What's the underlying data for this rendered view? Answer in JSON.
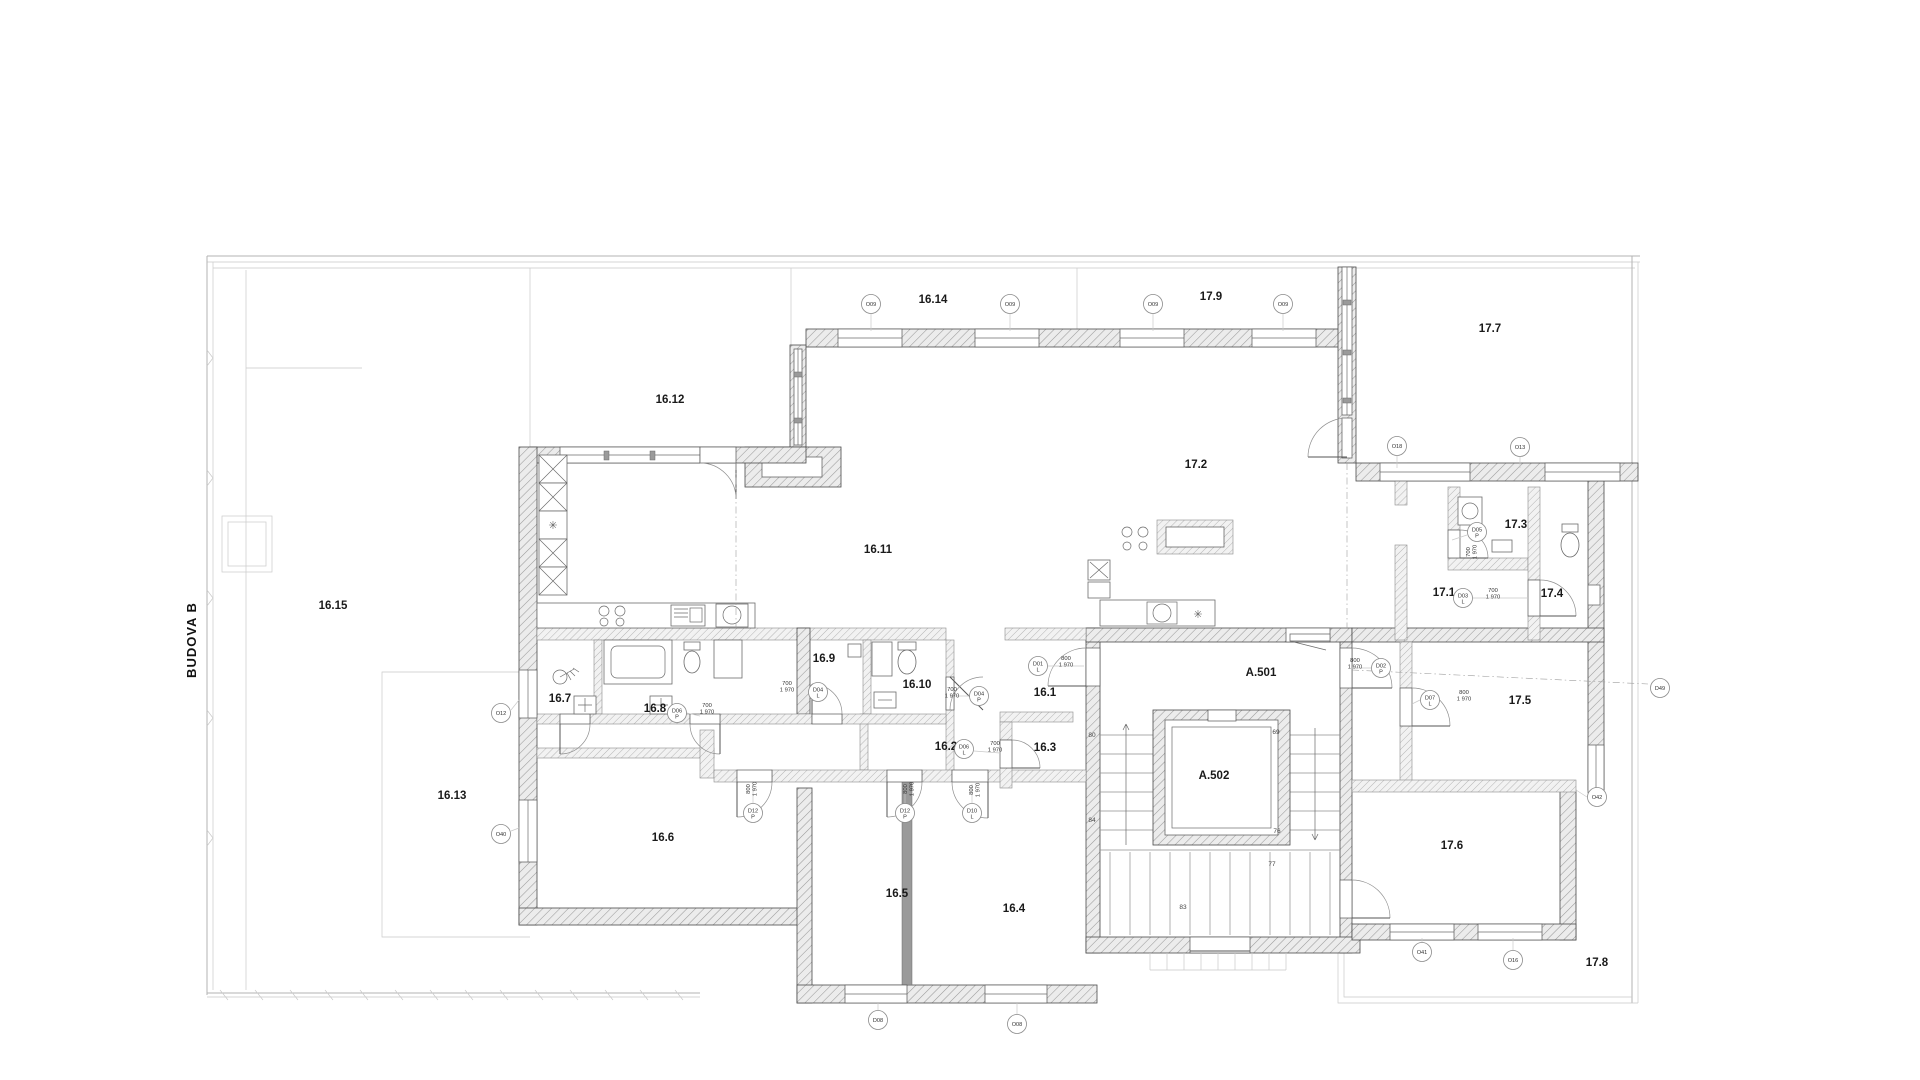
{
  "drawing": {
    "building_label": "BUDOVA B",
    "colors": {
      "wall_line": "#4a4a4a",
      "hatch": "#9a9a9a",
      "light_line": "#b3b3b3",
      "text": "#1a1a1a"
    },
    "rooms": [
      {
        "id": "16.15",
        "x": 333,
        "y": 609
      },
      {
        "id": "16.12",
        "x": 670,
        "y": 403
      },
      {
        "id": "16.14",
        "x": 933,
        "y": 303
      },
      {
        "id": "17.9",
        "x": 1211,
        "y": 300
      },
      {
        "id": "17.7",
        "x": 1490,
        "y": 332
      },
      {
        "id": "16.11",
        "x": 878,
        "y": 553
      },
      {
        "id": "17.2",
        "x": 1196,
        "y": 468
      },
      {
        "id": "17.3",
        "x": 1516,
        "y": 528
      },
      {
        "id": "17.1",
        "x": 1444,
        "y": 596
      },
      {
        "id": "17.4",
        "x": 1552,
        "y": 597
      },
      {
        "id": "16.9",
        "x": 824,
        "y": 662
      },
      {
        "id": "16.10",
        "x": 917,
        "y": 688
      },
      {
        "id": "16.1",
        "x": 1045,
        "y": 696
      },
      {
        "id": "A.501",
        "x": 1261,
        "y": 676
      },
      {
        "id": "17.5",
        "x": 1520,
        "y": 704
      },
      {
        "id": "16.7",
        "x": 560,
        "y": 702
      },
      {
        "id": "16.8",
        "x": 655,
        "y": 712
      },
      {
        "id": "16.2",
        "x": 946,
        "y": 750
      },
      {
        "id": "16.3",
        "x": 1045,
        "y": 751
      },
      {
        "id": "16.13",
        "x": 452,
        "y": 799
      },
      {
        "id": "A.502",
        "x": 1214,
        "y": 779
      },
      {
        "id": "16.6",
        "x": 663,
        "y": 841
      },
      {
        "id": "17.6",
        "x": 1452,
        "y": 849
      },
      {
        "id": "16.5",
        "x": 897,
        "y": 897
      },
      {
        "id": "16.4",
        "x": 1014,
        "y": 912
      },
      {
        "id": "17.8",
        "x": 1597,
        "y": 966
      }
    ],
    "markers": [
      {
        "code": "O09",
        "x": 871,
        "y": 304
      },
      {
        "code": "O09",
        "x": 1010,
        "y": 304
      },
      {
        "code": "O09",
        "x": 1153,
        "y": 304
      },
      {
        "code": "O09",
        "x": 1283,
        "y": 304
      },
      {
        "code": "O18",
        "x": 1397,
        "y": 446
      },
      {
        "code": "O13",
        "x": 1520,
        "y": 447
      },
      {
        "code": "O12",
        "x": 501,
        "y": 713
      },
      {
        "code": "O40",
        "x": 501,
        "y": 834
      },
      {
        "code": "D08",
        "x": 878,
        "y": 1020
      },
      {
        "code": "O08",
        "x": 1017,
        "y": 1024
      },
      {
        "code": "O41",
        "x": 1422,
        "y": 952
      },
      {
        "code": "O16",
        "x": 1513,
        "y": 960
      },
      {
        "code": "O42",
        "x": 1597,
        "y": 797
      },
      {
        "code": "D49",
        "x": 1660,
        "y": 688
      },
      {
        "code": "D05",
        "suffix": "P",
        "x": 1477,
        "y": 532
      },
      {
        "code": "D03",
        "suffix": "L",
        "x": 1463,
        "y": 598
      },
      {
        "code": "D01",
        "suffix": "L",
        "x": 1038,
        "y": 666
      },
      {
        "code": "D04",
        "suffix": "P",
        "x": 979,
        "y": 696
      },
      {
        "code": "D04",
        "suffix": "L",
        "x": 818,
        "y": 692
      },
      {
        "code": "D06",
        "suffix": "L",
        "x": 964,
        "y": 749
      },
      {
        "code": "D06",
        "suffix": "P",
        "x": 677,
        "y": 713
      },
      {
        "code": "D12",
        "suffix": "P",
        "x": 753,
        "y": 813
      },
      {
        "code": "D12",
        "suffix": "P",
        "x": 905,
        "y": 813
      },
      {
        "code": "D10",
        "suffix": "L",
        "x": 972,
        "y": 813
      },
      {
        "code": "D02",
        "suffix": "P",
        "x": 1381,
        "y": 668
      },
      {
        "code": "D07",
        "suffix": "L",
        "x": 1430,
        "y": 700
      }
    ],
    "dims": [
      {
        "t1": "700",
        "t2": "1 970",
        "x": 787,
        "y": 685,
        "rot": false
      },
      {
        "t1": "700",
        "t2": "1 970",
        "x": 952,
        "y": 691,
        "rot": false
      },
      {
        "t1": "800",
        "t2": "1 970",
        "x": 1066,
        "y": 660,
        "rot": false
      },
      {
        "t1": "700",
        "t2": "1 970",
        "x": 707,
        "y": 707,
        "rot": false
      },
      {
        "t1": "700",
        "t2": "1 970",
        "x": 995,
        "y": 745,
        "rot": false
      },
      {
        "t1": "800",
        "t2": "1 970",
        "x": 750,
        "y": 789,
        "rot": true
      },
      {
        "t1": "800",
        "t2": "1 970",
        "x": 907,
        "y": 789,
        "rot": true
      },
      {
        "t1": "800",
        "t2": "1 970",
        "x": 973,
        "y": 790,
        "rot": true
      },
      {
        "t1": "700",
        "t2": "1 970",
        "x": 1470,
        "y": 552,
        "rot": true
      },
      {
        "t1": "700",
        "t2": "1 970",
        "x": 1493,
        "y": 592,
        "rot": false
      },
      {
        "t1": "800",
        "t2": "1 970",
        "x": 1355,
        "y": 662,
        "rot": false
      },
      {
        "t1": "800",
        "t2": "1 970",
        "x": 1464,
        "y": 694,
        "rot": false
      }
    ],
    "stair_steps": [
      {
        "n": "80",
        "x": 1092,
        "y": 737
      },
      {
        "n": "84",
        "x": 1092,
        "y": 822
      },
      {
        "n": "69",
        "x": 1276,
        "y": 734
      },
      {
        "n": "76",
        "x": 1277,
        "y": 833
      },
      {
        "n": "77",
        "x": 1272,
        "y": 866
      },
      {
        "n": "83",
        "x": 1183,
        "y": 909
      }
    ]
  }
}
